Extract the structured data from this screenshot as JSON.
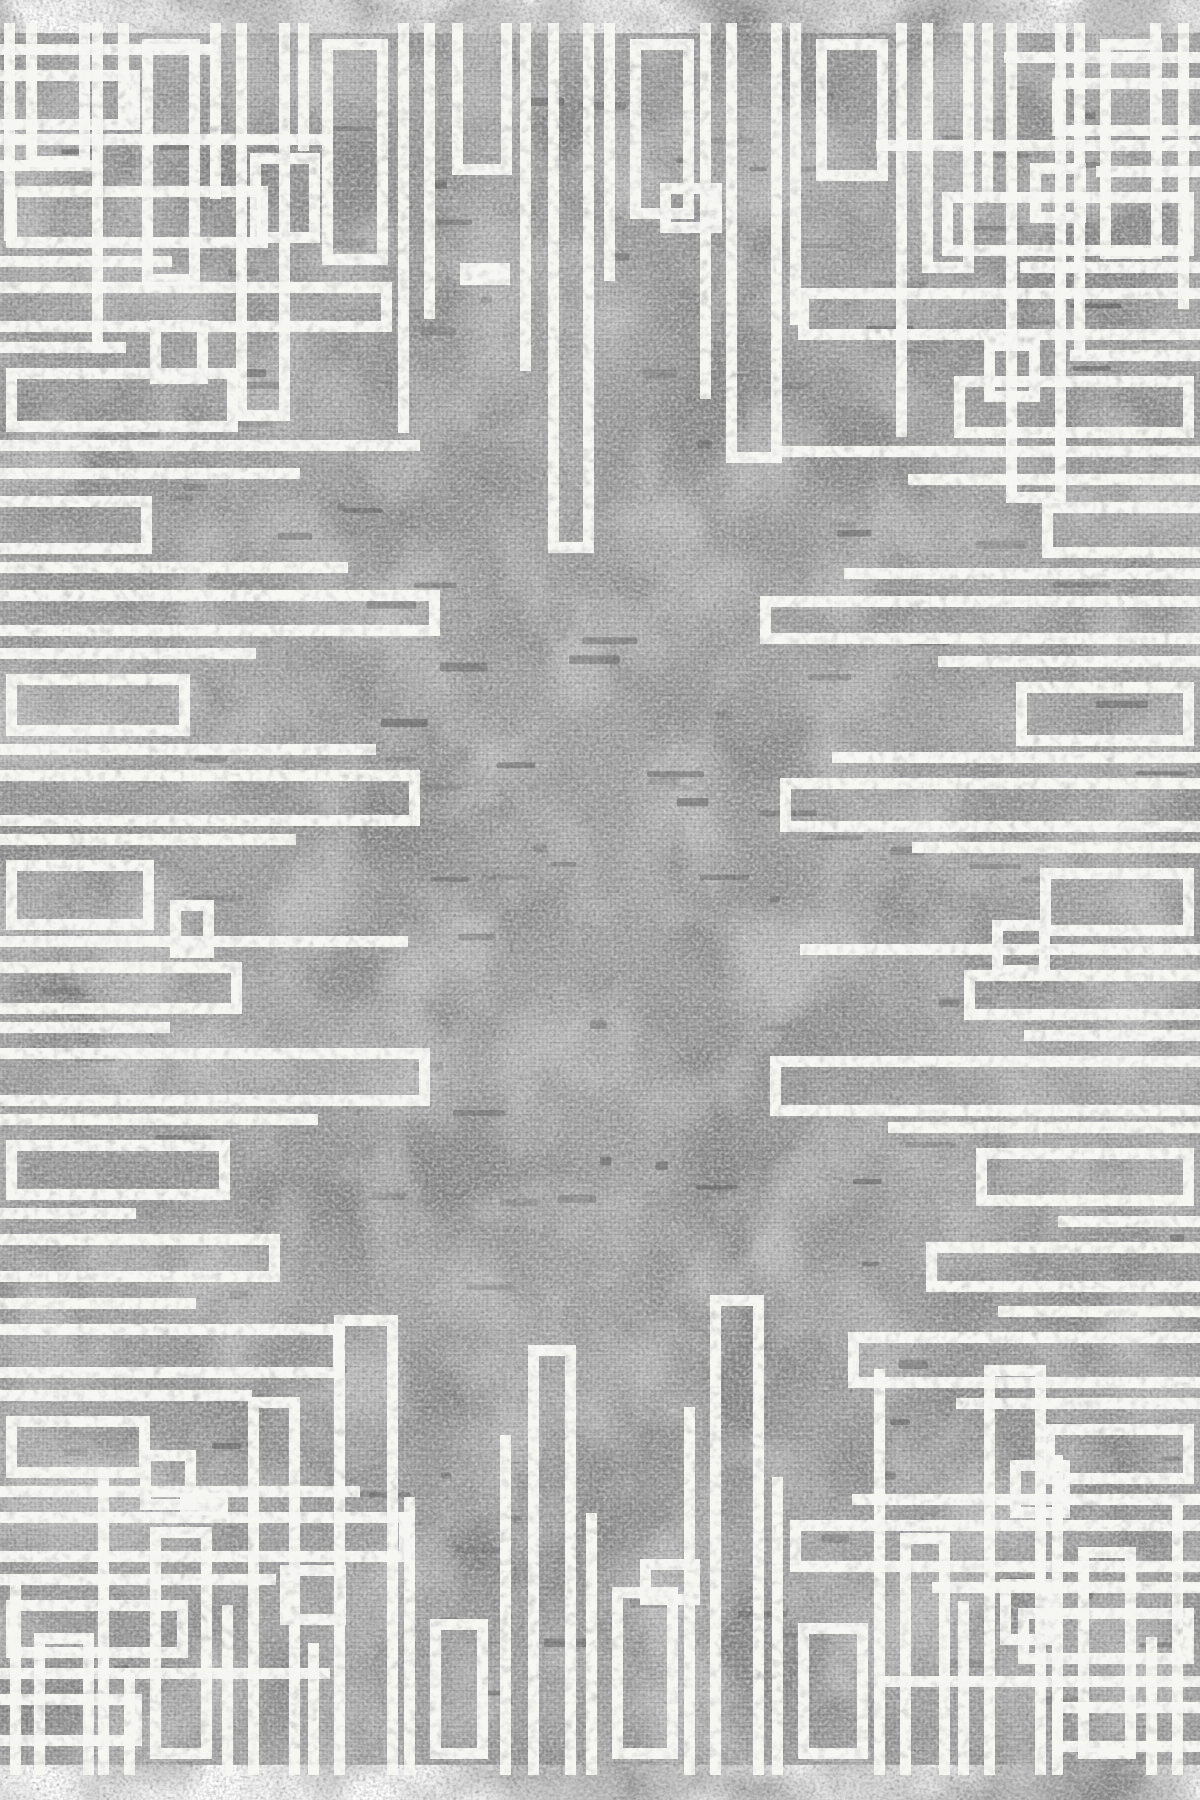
{
  "image": {
    "type": "rug-product-photo",
    "description": "Rectangular area rug with mottled stonewashed gray field and distressed white geometric meander border pattern of overlapping bars, U-shapes and rectangular frames extending inward from all four edges",
    "canvas": {
      "width": 1200,
      "height": 1800
    },
    "rug": {
      "left": 0,
      "top": 33,
      "right": 1200,
      "bottom": 1765
    },
    "palette": {
      "page_background": "#ffffff",
      "field_base": "#a7a7a7",
      "field_dark_patch": "#8e8e8e",
      "field_light_patch": "#c3c3c3",
      "grain_dark": "#555555",
      "grain_light": "#e2e2e2",
      "stitch_dark": "#454545",
      "pattern_white": "#f6f6f3"
    },
    "pattern": {
      "stroke_width": 11,
      "edges": {
        "top": [
          [
            4,
            208,
            0,
            0
          ],
          [
            26,
            134,
            64,
            1
          ],
          [
            92,
            318,
            0,
            0
          ],
          [
            118,
            86,
            0,
            0
          ],
          [
            142,
            252,
            58,
            2
          ],
          [
            210,
            166,
            0,
            0
          ],
          [
            236,
            388,
            54,
            1
          ],
          [
            250,
            210,
            70,
            2,
            120
          ],
          [
            298,
            118,
            0,
            0
          ],
          [
            322,
            232,
            66,
            2
          ],
          [
            398,
            400,
            0,
            0
          ],
          [
            424,
            286,
            0,
            0
          ],
          [
            452,
            142,
            60,
            1
          ],
          [
            460,
            160,
            50,
            2,
            230
          ],
          [
            520,
            338,
            0,
            0
          ],
          [
            548,
            520,
            46,
            1
          ],
          [
            604,
            248,
            0,
            0
          ],
          [
            630,
            186,
            64,
            2
          ],
          [
            660,
            200,
            62,
            2,
            150
          ],
          [
            700,
            366,
            0,
            0
          ],
          [
            726,
            430,
            56,
            1
          ],
          [
            790,
            292,
            0,
            0
          ],
          [
            816,
            148,
            72,
            2
          ],
          [
            896,
            404,
            0,
            0
          ],
          [
            922,
            240,
            52,
            1
          ],
          [
            982,
            168,
            0,
            0
          ],
          [
            1006,
            470,
            60,
            1
          ],
          [
            1030,
            190,
            56,
            2,
            130
          ],
          [
            1074,
            322,
            0,
            0
          ],
          [
            1100,
            226,
            62,
            2
          ],
          [
            1150,
            118,
            0,
            0
          ],
          [
            1178,
            276,
            0,
            0
          ]
        ],
        "bottom": [
          [
            10,
            188,
            0,
            0
          ],
          [
            34,
            132,
            60,
            1
          ],
          [
            98,
            296,
            0,
            0
          ],
          [
            124,
            92,
            0,
            0
          ],
          [
            150,
            238,
            62,
            2
          ],
          [
            180,
            150,
            48,
            2,
            250
          ],
          [
            222,
            160,
            0,
            0
          ],
          [
            248,
            368,
            52,
            1
          ],
          [
            280,
            200,
            66,
            2,
            140
          ],
          [
            308,
            122,
            0,
            0
          ],
          [
            334,
            450,
            64,
            1
          ],
          [
            404,
            268,
            0,
            0
          ],
          [
            430,
            146,
            58,
            2
          ],
          [
            500,
            330,
            0,
            0
          ],
          [
            528,
            420,
            48,
            1
          ],
          [
            586,
            252,
            0,
            0
          ],
          [
            612,
            178,
            66,
            2
          ],
          [
            640,
            206,
            60,
            2,
            160
          ],
          [
            684,
            358,
            0,
            0
          ],
          [
            710,
            470,
            54,
            1
          ],
          [
            772,
            288,
            0,
            0
          ],
          [
            798,
            142,
            70,
            2
          ],
          [
            874,
            396,
            0,
            0
          ],
          [
            900,
            232,
            50,
            1
          ],
          [
            958,
            164,
            0,
            0
          ],
          [
            984,
            400,
            62,
            1
          ],
          [
            1000,
            186,
            54,
            2,
            120
          ],
          [
            1052,
            310,
            0,
            0
          ],
          [
            1078,
            218,
            58,
            2
          ],
          [
            1146,
            128,
            0,
            0
          ],
          [
            1172,
            262,
            0,
            0
          ]
        ],
        "left": [
          [
            44,
            214,
            0,
            0
          ],
          [
            70,
            140,
            60,
            1
          ],
          [
            134,
            332,
            0,
            0
          ],
          [
            160,
            98,
            0,
            0
          ],
          [
            186,
            268,
            62,
            2
          ],
          [
            256,
            172,
            0,
            0
          ],
          [
            282,
            392,
            50,
            1
          ],
          [
            320,
            208,
            64,
            2,
            150
          ],
          [
            342,
            126,
            0,
            0
          ],
          [
            368,
            238,
            64,
            2
          ],
          [
            440,
            420,
            0,
            0
          ],
          [
            468,
            300,
            0,
            0
          ],
          [
            496,
            152,
            58,
            1
          ],
          [
            562,
            348,
            0,
            0
          ],
          [
            590,
            440,
            46,
            1
          ],
          [
            648,
            256,
            0,
            0
          ],
          [
            674,
            190,
            62,
            2
          ],
          [
            744,
            376,
            0,
            0
          ],
          [
            770,
            420,
            56,
            1
          ],
          [
            834,
            296,
            0,
            0
          ],
          [
            860,
            154,
            70,
            2
          ],
          [
            900,
            214,
            58,
            2,
            170
          ],
          [
            936,
            408,
            0,
            0
          ],
          [
            962,
            242,
            52,
            1
          ],
          [
            1022,
            170,
            0,
            0
          ],
          [
            1048,
            430,
            58,
            1
          ],
          [
            1114,
            318,
            0,
            0
          ],
          [
            1140,
            230,
            60,
            2
          ],
          [
            1208,
            136,
            0,
            0
          ],
          [
            1234,
            280,
            48,
            1
          ],
          [
            1298,
            196,
            0,
            0
          ],
          [
            1324,
            344,
            54,
            1
          ],
          [
            1390,
            252,
            0,
            0
          ],
          [
            1416,
            150,
            62,
            2
          ],
          [
            1450,
            196,
            60,
            2,
            140
          ],
          [
            1486,
            360,
            0,
            0
          ],
          [
            1512,
            410,
            50,
            1
          ],
          [
            1574,
            276,
            0,
            0
          ],
          [
            1600,
            188,
            58,
            2
          ],
          [
            1668,
            330,
            0,
            0
          ],
          [
            1694,
            142,
            52,
            1
          ]
        ],
        "right": [
          [
            52,
            196,
            0,
            0
          ],
          [
            78,
            148,
            58,
            1
          ],
          [
            140,
            324,
            0,
            0
          ],
          [
            166,
            104,
            0,
            0
          ],
          [
            192,
            258,
            64,
            2
          ],
          [
            262,
            180,
            0,
            0
          ],
          [
            288,
            402,
            52,
            1
          ],
          [
            340,
            216,
            62,
            2,
            160
          ],
          [
            350,
            130,
            0,
            0
          ],
          [
            376,
            246,
            62,
            2
          ],
          [
            446,
            420,
            0,
            0
          ],
          [
            474,
            292,
            0,
            0
          ],
          [
            502,
            158,
            56,
            1
          ],
          [
            568,
            356,
            0,
            0
          ],
          [
            596,
            440,
            48,
            1
          ],
          [
            656,
            262,
            0,
            0
          ],
          [
            682,
            184,
            64,
            2
          ],
          [
            752,
            368,
            0,
            0
          ],
          [
            778,
            420,
            54,
            1
          ],
          [
            842,
            288,
            0,
            0
          ],
          [
            868,
            160,
            68,
            2
          ],
          [
            920,
            208,
            56,
            2,
            150
          ],
          [
            944,
            400,
            0,
            0
          ],
          [
            970,
            236,
            50,
            1
          ],
          [
            1030,
            176,
            0,
            0
          ],
          [
            1056,
            430,
            60,
            1
          ],
          [
            1122,
            312,
            0,
            0
          ],
          [
            1148,
            224,
            58,
            2
          ],
          [
            1216,
            142,
            0,
            0
          ],
          [
            1242,
            274,
            50,
            1
          ],
          [
            1306,
            202,
            0,
            0
          ],
          [
            1332,
            352,
            56,
            1
          ],
          [
            1398,
            244,
            0,
            0
          ],
          [
            1424,
            156,
            60,
            2
          ],
          [
            1460,
            190,
            58,
            2,
            130
          ],
          [
            1494,
            348,
            0,
            0
          ],
          [
            1520,
            410,
            52,
            1
          ],
          [
            1582,
            268,
            0,
            0
          ],
          [
            1608,
            182,
            56,
            2
          ],
          [
            1676,
            322,
            0,
            0
          ],
          [
            1702,
            148,
            50,
            1
          ]
        ]
      }
    },
    "speckles": {
      "seed": 1337,
      "count": 150,
      "min_width": 8,
      "max_width": 58,
      "min_height": 4,
      "max_height": 9,
      "min_opacity": 0.12,
      "max_opacity": 0.42
    }
  }
}
